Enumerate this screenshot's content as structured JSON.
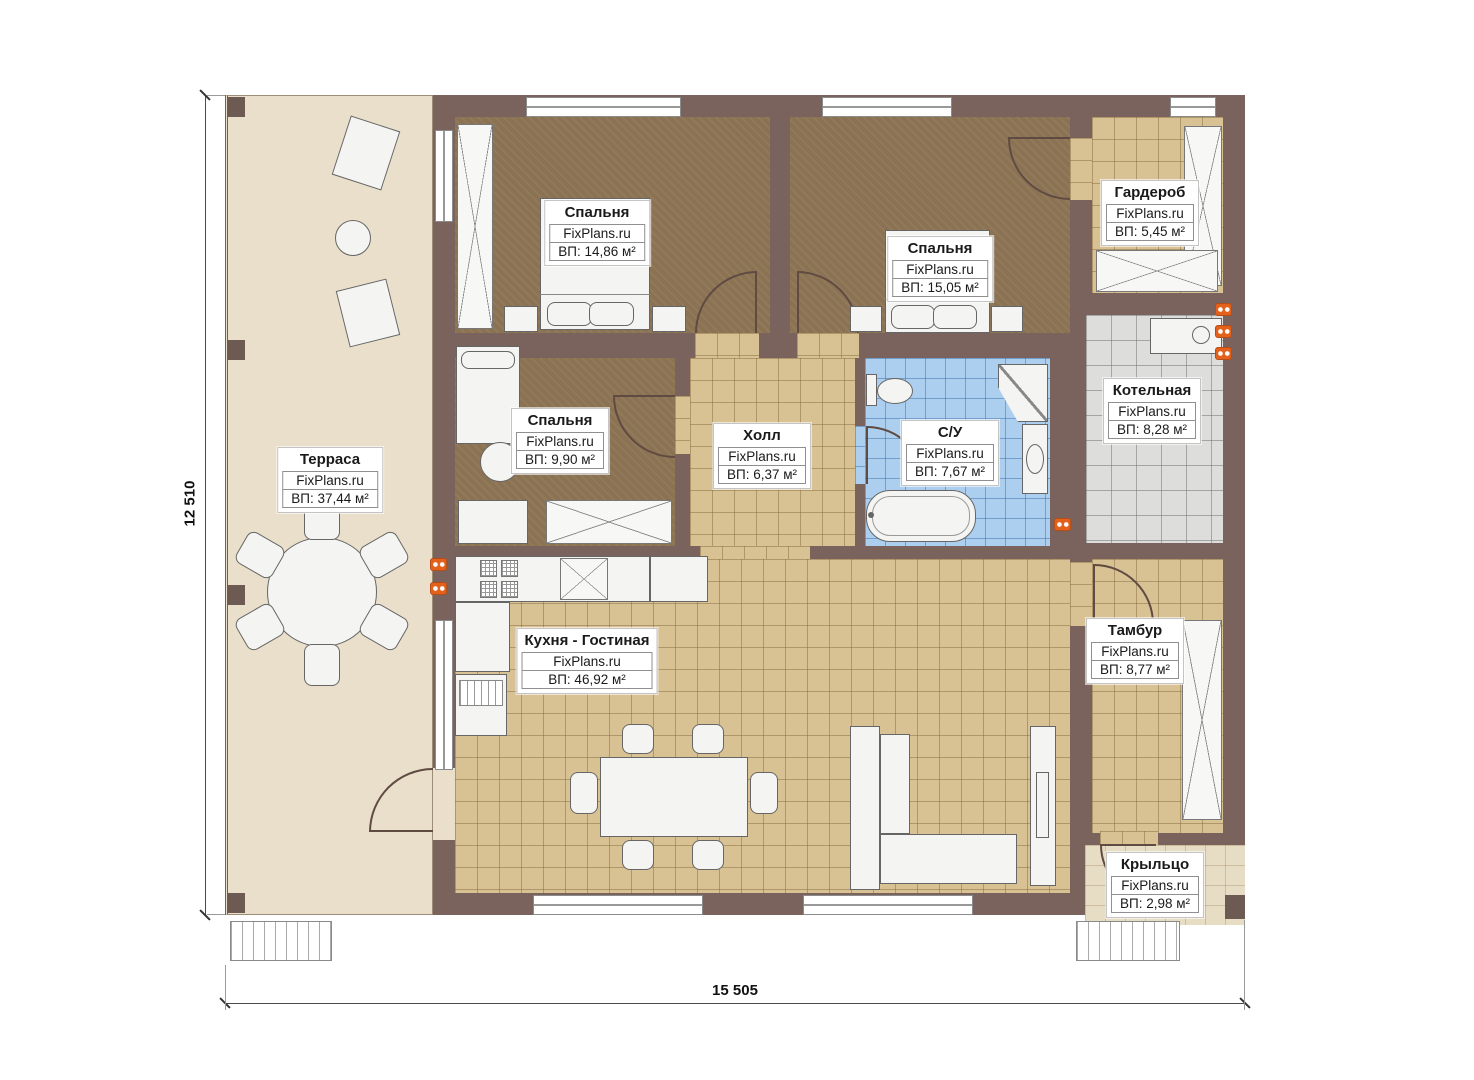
{
  "plan": {
    "brand": "FixPlans.ru",
    "dimensions": {
      "height_label": "12 510",
      "width_label": "15 505"
    },
    "rooms": [
      {
        "name": "Терраса",
        "area": "ВП: 37,44 м²"
      },
      {
        "name": "Спальня",
        "area": "ВП: 14,86 м²"
      },
      {
        "name": "Спальня",
        "area": "ВП: 15,05 м²"
      },
      {
        "name": "Гардероб",
        "area": "ВП: 5,45 м²"
      },
      {
        "name": "Котельная",
        "area": "ВП: 8,28 м²"
      },
      {
        "name": "Спальня",
        "area": "ВП: 9,90 м²"
      },
      {
        "name": "Холл",
        "area": "ВП: 6,37 м²"
      },
      {
        "name": "С/У",
        "area": "ВП: 7,67 м²"
      },
      {
        "name": "Кухня - Гостиная",
        "area": "ВП: 46,92 м²"
      },
      {
        "name": "Тамбур",
        "area": "ВП: 8,77 м²"
      },
      {
        "name": "Крыльцо",
        "area": "ВП: 2,98 м²"
      }
    ],
    "colors": {
      "wall": "#7a635c",
      "terrace_floor": "#e9dfca",
      "bedroom_floor": "#8a7252",
      "tile_tan": "#d8c193",
      "tile_gray": "#dddddb",
      "tile_blue": "#accff0",
      "radiator_orange": "#e4611c"
    }
  }
}
